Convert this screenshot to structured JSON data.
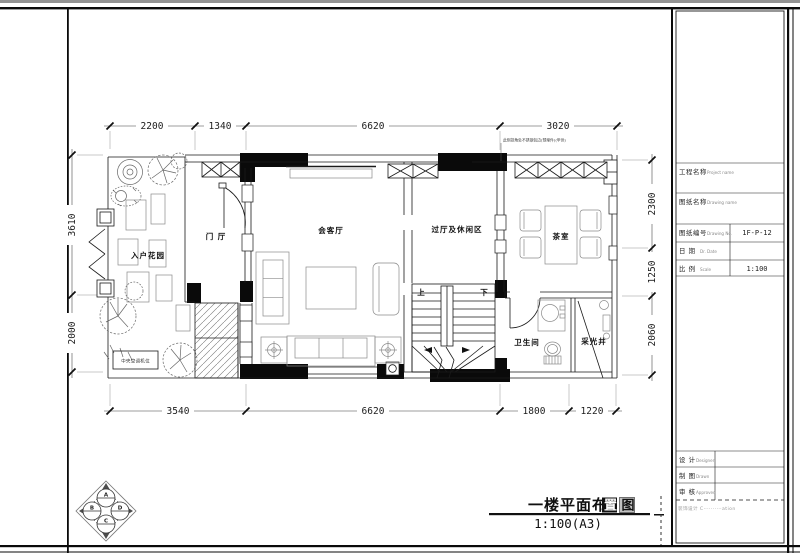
{
  "plan": {
    "rooms": {
      "entry_garden": "入户花园",
      "foyer": "门 厅",
      "living": "会客厅",
      "hall": "过厅及休闲区",
      "tea": "茶室",
      "bath": "卫生间",
      "light_well": "采光井",
      "ac_unit": "中央空调机位",
      "stair_up": "上",
      "stair_down": "下"
    },
    "annotation": "此侧拐角处不锈钢包边(预埋件)(甲供)",
    "dims": {
      "top": [
        "2200",
        "1340",
        "6620",
        "3020"
      ],
      "bottom": [
        "3540",
        "6620",
        "1800",
        "1220"
      ],
      "left": [
        "3610",
        "2000"
      ],
      "right": [
        "2300",
        "1250",
        "2060"
      ]
    },
    "compass": {
      "top": "A",
      "left": "B",
      "right": "D",
      "bottom": "C"
    }
  },
  "title_block": {
    "project_label": "工程名称",
    "project_label_en": "Project name",
    "drawing_name_label": "图纸名称",
    "drawing_name_label_en": "Drawing name",
    "drawing_no_label": "图纸编号",
    "drawing_no_label_en": "Drawing No.",
    "drawing_no": "1F-P-12",
    "date_label": "日 期",
    "date_label_en": "Dr. Date",
    "date": "",
    "scale_label": "比 例",
    "scale_label_en": "Scale",
    "scale": "1:100",
    "designer_label": "设 计",
    "designer_label_en": "Designer",
    "drawn_label": "制 图",
    "drawn_label_en": "Drawn",
    "approved_label": "审 核",
    "approved_label_en": "Approved",
    "watermark": "装饰设计 C··········ation"
  },
  "footer": {
    "title_prefix": "一楼平面布",
    "title_inverted_char": "置",
    "title_boxed_char": "图",
    "scale_text": "1:100(A3)"
  },
  "colors": {
    "wall": "#0a0a0a",
    "line": "#1a1a1a",
    "furniture": "#8a8a8a",
    "accent_inverse": "#bbbbbb"
  }
}
